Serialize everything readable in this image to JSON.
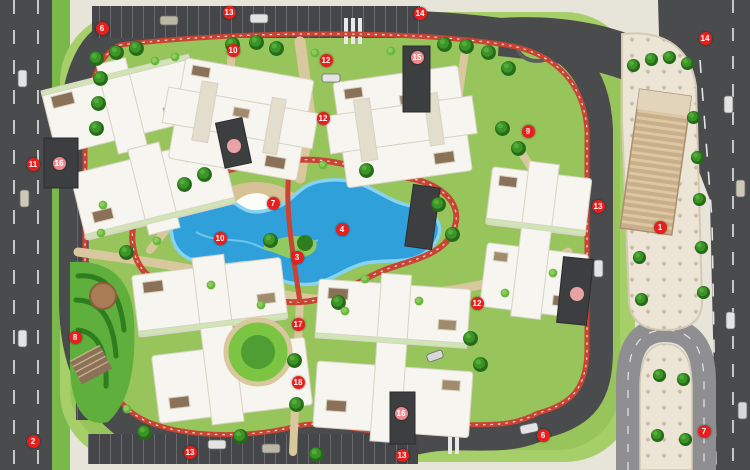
{
  "map": {
    "kind": "residential-compound-master-plan",
    "marker_icon": "numbered-location-marker",
    "marker_count": 27
  },
  "palette": {
    "marker_red": "#e8201d",
    "marker_pink": "#ee8a8c",
    "road_gray": "#4a4b4d",
    "track_red": "#c94434",
    "lagoon_blue": "#2fa0da",
    "lagoon_rim": "#85d4f2",
    "lawn_green": "#a6ce69",
    "tree_green": "#2e7d1e",
    "path_tan": "#d9c79d",
    "building_white": "#f7f5ef",
    "roof_brown": "#8a7157",
    "plaza_beige": "#eae2d2"
  },
  "markers": [
    {
      "n": "6",
      "x": 102,
      "y": 28,
      "variant": "red"
    },
    {
      "n": "13",
      "x": 229,
      "y": 12,
      "variant": "red"
    },
    {
      "n": "10",
      "x": 233,
      "y": 50,
      "variant": "red"
    },
    {
      "n": "14",
      "x": 420,
      "y": 13,
      "variant": "red"
    },
    {
      "n": "12",
      "x": 326,
      "y": 60,
      "variant": "red"
    },
    {
      "n": "15",
      "x": 417,
      "y": 57,
      "variant": "pink"
    },
    {
      "n": "12",
      "x": 323,
      "y": 118,
      "variant": "red"
    },
    {
      "n": "11",
      "x": 33,
      "y": 164,
      "variant": "red"
    },
    {
      "n": "16",
      "x": 59,
      "y": 163,
      "variant": "pink"
    },
    {
      "n": "10",
      "x": 220,
      "y": 238,
      "variant": "red"
    },
    {
      "n": "7",
      "x": 273,
      "y": 203,
      "variant": "red"
    },
    {
      "n": "4",
      "x": 342,
      "y": 229,
      "variant": "red"
    },
    {
      "n": "3",
      "x": 297,
      "y": 257,
      "variant": "red"
    },
    {
      "n": "9",
      "x": 528,
      "y": 131,
      "variant": "red"
    },
    {
      "n": "12",
      "x": 477,
      "y": 303,
      "variant": "red"
    },
    {
      "n": "13",
      "x": 598,
      "y": 206,
      "variant": "red"
    },
    {
      "n": "1",
      "x": 660,
      "y": 227,
      "variant": "red"
    },
    {
      "n": "14",
      "x": 705,
      "y": 38,
      "variant": "red"
    },
    {
      "n": "8",
      "x": 75,
      "y": 337,
      "variant": "red"
    },
    {
      "n": "2",
      "x": 33,
      "y": 441,
      "variant": "red"
    },
    {
      "n": "13",
      "x": 190,
      "y": 452,
      "variant": "red"
    },
    {
      "n": "17",
      "x": 298,
      "y": 324,
      "variant": "red"
    },
    {
      "n": "18",
      "x": 298,
      "y": 382,
      "variant": "red"
    },
    {
      "n": "16",
      "x": 401,
      "y": 413,
      "variant": "pink"
    },
    {
      "n": "13",
      "x": 402,
      "y": 455,
      "variant": "red"
    },
    {
      "n": "6",
      "x": 543,
      "y": 435,
      "variant": "red"
    },
    {
      "n": "7",
      "x": 704,
      "y": 431,
      "variant": "red"
    }
  ]
}
